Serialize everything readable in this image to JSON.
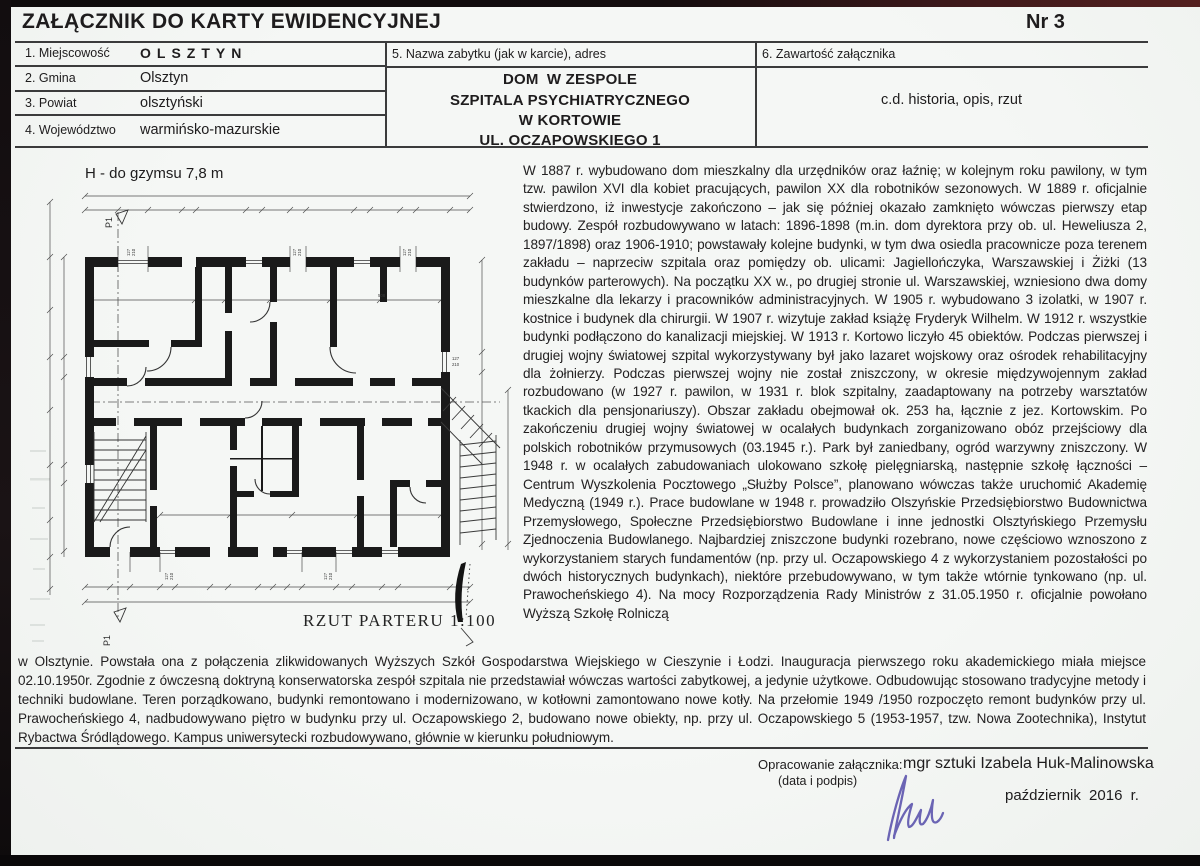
{
  "header": {
    "title": "ZAŁĄCZNIK DO KARTY EWIDENCYJNEJ",
    "number": "Nr 3"
  },
  "fields": [
    {
      "label": "1. Miejscowość",
      "value": "OLSZTYN"
    },
    {
      "label": "2. Gmina",
      "value": "Olsztyn"
    },
    {
      "label": "3. Powiat",
      "value": "olsztyński"
    },
    {
      "label": "4. Województwo",
      "value": "warmińsko-mazurskie"
    }
  ],
  "monument": {
    "label": "5. Nazwa zabytku (jak w karcie), adres",
    "name_bold": "DOM",
    "name_rest": "W ZESPOLE",
    "name_line2": "SZPITALA PSYCHIATRYCZNEGO",
    "name_line3": "W KORTOWIE",
    "name_line4": "UL. OCZAPOWSKIEGO 1"
  },
  "contents": {
    "label": "6. Zawartość załącznika",
    "value": "c.d. historia, opis, rzut"
  },
  "plan": {
    "height_note": "H - do gzymsu 7,8 m",
    "caption": "RZUT PARTERU 1:100",
    "marker": "P1",
    "window_dim_w": "127",
    "window_dim_h": "210",
    "room_dim": "508"
  },
  "history": "W 1887 r. wybudowano dom mieszkalny dla urzędników oraz łaźnię; w kolejnym roku pawilony, w tym tzw. pawilon XVI dla kobiet pracujących, pawilon XX dla robotników sezonowych. W 1889 r. oficjalnie stwierdzono, iż inwestycje zakończono – jak się później okazało zamknięto wówczas pierwszy etap budowy. Zespół rozbudowywano w latach: 1896-1898 (m.in. dom dyrektora przy ob. ul. Heweliusza 2, 1897/1898) oraz 1906-1910; powstawały kolejne budynki, w tym dwa osiedla pracownicze poza terenem zakładu – naprzeciw szpitala oraz pomiędzy ob. ulicami: Jagiellończyka, Warszawskiej i Żiżki (13 budynków parterowych). Na początku XX w., po drugiej stronie ul. Warszawskiej, wzniesiono dwa domy mieszkalne dla lekarzy i pracowników administracyjnych. W 1905 r. wybudowano 3 izolatki, w 1907 r. kostnice i budynek dla chirurgii. W 1907 r. wizytuje zakład książę Fryderyk Wilhelm. W 1912 r. wszystkie budynki podłączono do kanalizacji miejskiej. W 1913 r. Kortowo liczyło 45 obiektów. Podczas pierwszej i drugiej wojny światowej szpital wykorzystywany był jako lazaret wojskowy oraz ośrodek rehabilitacyjny dla żołnierzy. Podczas pierwszej wojny nie został zniszczony, w okresie międzywojennym zakład rozbudowano (w 1927 r. pawilon, w 1931 r. blok szpitalny, zaadaptowany na potrzeby warsztatów tkackich dla pensjonariuszy). Obszar zakładu obejmował ok. 253 ha, łącznie z jez. Kortowskim. Po zakończeniu drugiej wojny światowej w ocalałych budynkach zorganizowano obóz przejściowy dla polskich robotników przymusowych (03.1945 r.). Park był zaniedbany, ogród warzywny zniszczony. W 1948 r. w ocalałych zabudowaniach ulokowano szkołę pielęgniarską, następnie szkołę łączności – Centrum Wyszkolenia Pocztowego „Służby Polsce”, planowano wówczas także uruchomić Akademię Medyczną (1949 r.). Prace budowlane w 1948 r. prowadziło Olszyńskie Przedsiębiorstwo Budownictwa Przemysłowego, Społeczne Przedsiębiorstwo Budowlane i inne jednostki Olsztyńskiego Przemysłu Zjednoczenia Budowlanego. Najbardziej zniszczone budynki rozebrano, nowe częściowo wznoszono z wykorzystaniem starych fundamentów (np. przy ul. Oczapowskiego 4 z wykorzystaniem pozostałości po dwóch historycznych budynkach), niektóre przebudowywano, w tym także wtórnie tynkowano (np. ul. Prawocheńskiego 4). Na mocy Rozporządzenia Rady Ministrów z 31.05.1950 r. oficjalnie powołano Wyższą Szkołę Rolniczą",
  "history_continued": "w Olsztynie. Powstała ona z połączenia zlikwidowanych Wyższych Szkół Gospodarstwa Wiejskiego w Cieszynie i Łodzi. Inauguracja pierwszego roku akademickiego miała miejsce 02.10.1950r. Zgodnie z ówczesną doktryną konserwatorska zespół szpitala nie przedstawiał wówczas wartości zabytkowej, a jedynie użytkowe. Odbudowując stosowano tradycyjne metody i techniki budowlane. Teren porządkowano, budynki remontowano i modernizowano, w kotłowni zamontowano nowe kotły. Na przełomie 1949 /1950 rozpoczęto remont budynków przy ul. Prawocheńskiego 4, nadbudowywano piętro w budynku przy ul. Oczapowskiego 2, budowano nowe obiekty, np. przy ul. Oczapowskiego 5 (1953-1957, tzw. Nowa Zootechnika), Instytut Rybactwa Śródlądowego. Kampus uniwersytecki rozbudowywano, głównie w kierunku południowym.",
  "footer": {
    "prepared_label": "Opracowanie załącznika:",
    "prepared_sublabel": "(data i podpis)",
    "author": "mgr sztuki Izabela Huk-Malinowska",
    "date": "październik 2016 r."
  }
}
